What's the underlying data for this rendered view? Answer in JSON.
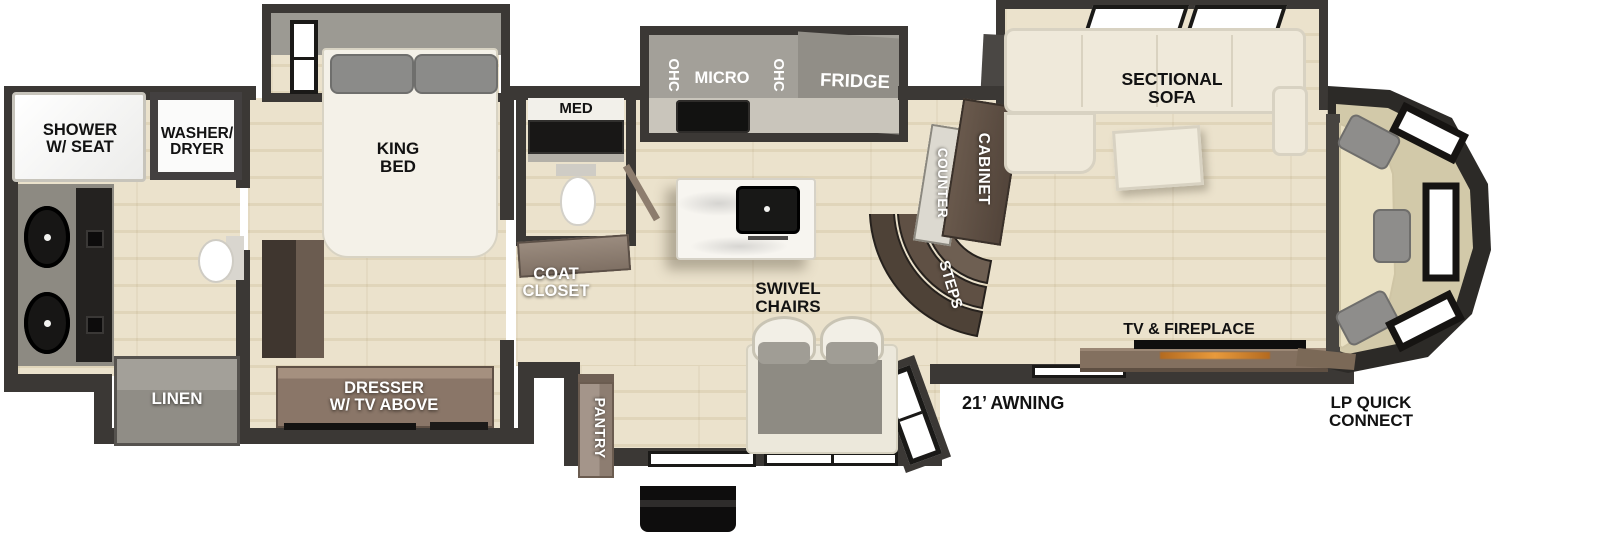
{
  "labels": {
    "shower": "SHOWER\nW/ SEAT",
    "washer_dryer": "WASHER/\nDRYER",
    "king_bed": "KING\nBED",
    "med": "MED",
    "ohc_left": "OHC",
    "micro": "MICRO",
    "ohc_right": "OHC",
    "fridge": "FRIDGE",
    "sectional_sofa": "SECTIONAL\nSOFA",
    "counter": "COUNTER",
    "cabinet": "CABINET",
    "steps": "STEPS",
    "coat_closet": "COAT\nCLOSET",
    "swivel_chairs": "SWIVEL\nCHAIRS",
    "pantry": "PANTRY",
    "linen": "LINEN",
    "dresser": "DRESSER\nW/ TV ABOVE",
    "tv_fireplace": "TV & FIREPLACE",
    "awning": "21’ AWNING",
    "lp_quick_connect": "LP QUICK\nCONNECT"
  },
  "colors": {
    "wall": "#3b3835",
    "floor_wood": "#e8dfc9",
    "slide_gray": "#a3a099",
    "cabinet_brown": "#5d4f43",
    "console_brown": "#83705f",
    "sofa_cream": "#efe9da",
    "island_white": "#f7f5f0",
    "fixture_black": "#161514",
    "cap_seat": "#eae1c3",
    "label_dark": "#121212",
    "label_light": "#ffffff"
  }
}
